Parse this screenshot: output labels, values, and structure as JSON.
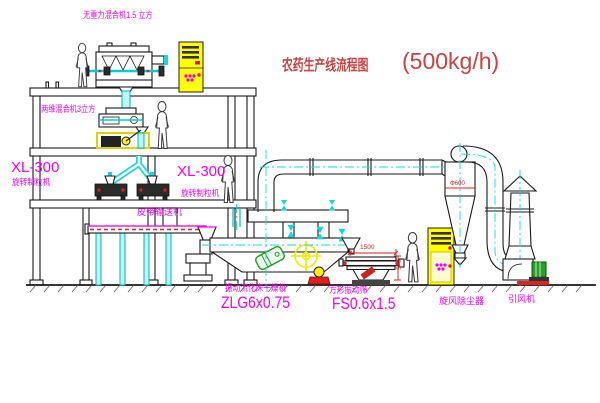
{
  "title": {
    "name": "农药生产线流程图",
    "capacity": "(500kg/h)"
  },
  "labels": {
    "top_mixer": "无重力混合机1.5 立方",
    "second_mixer": "两维混合机3立方",
    "granulator_left_model": "XL-300",
    "granulator_left_name": "旋转制粒机",
    "granulator_mid_model": "XL-300",
    "granulator_mid_name": "旋转制粒机",
    "belt_conveyor": "皮带输送机",
    "dryer_name": "振动流化床干燥机",
    "dryer_model": "ZLG6x0.75",
    "screen_name": "方形振动筛",
    "screen_model": "FS0.6x1.5",
    "cyclone_name": "旋风除尘器",
    "fan_name": "引风机"
  },
  "dimensions": {
    "screen_length": "1500",
    "screen_height": "545",
    "cyclone_dia": "Φ600"
  },
  "colors": {
    "label_magenta": "#f400f4",
    "title_red": "#cb4242",
    "dimension_red": "#dd2222",
    "pipe_cyan": "#00bcbc",
    "cabinet_yellow": "#ffff00",
    "motor_green": "#2aa02a"
  }
}
